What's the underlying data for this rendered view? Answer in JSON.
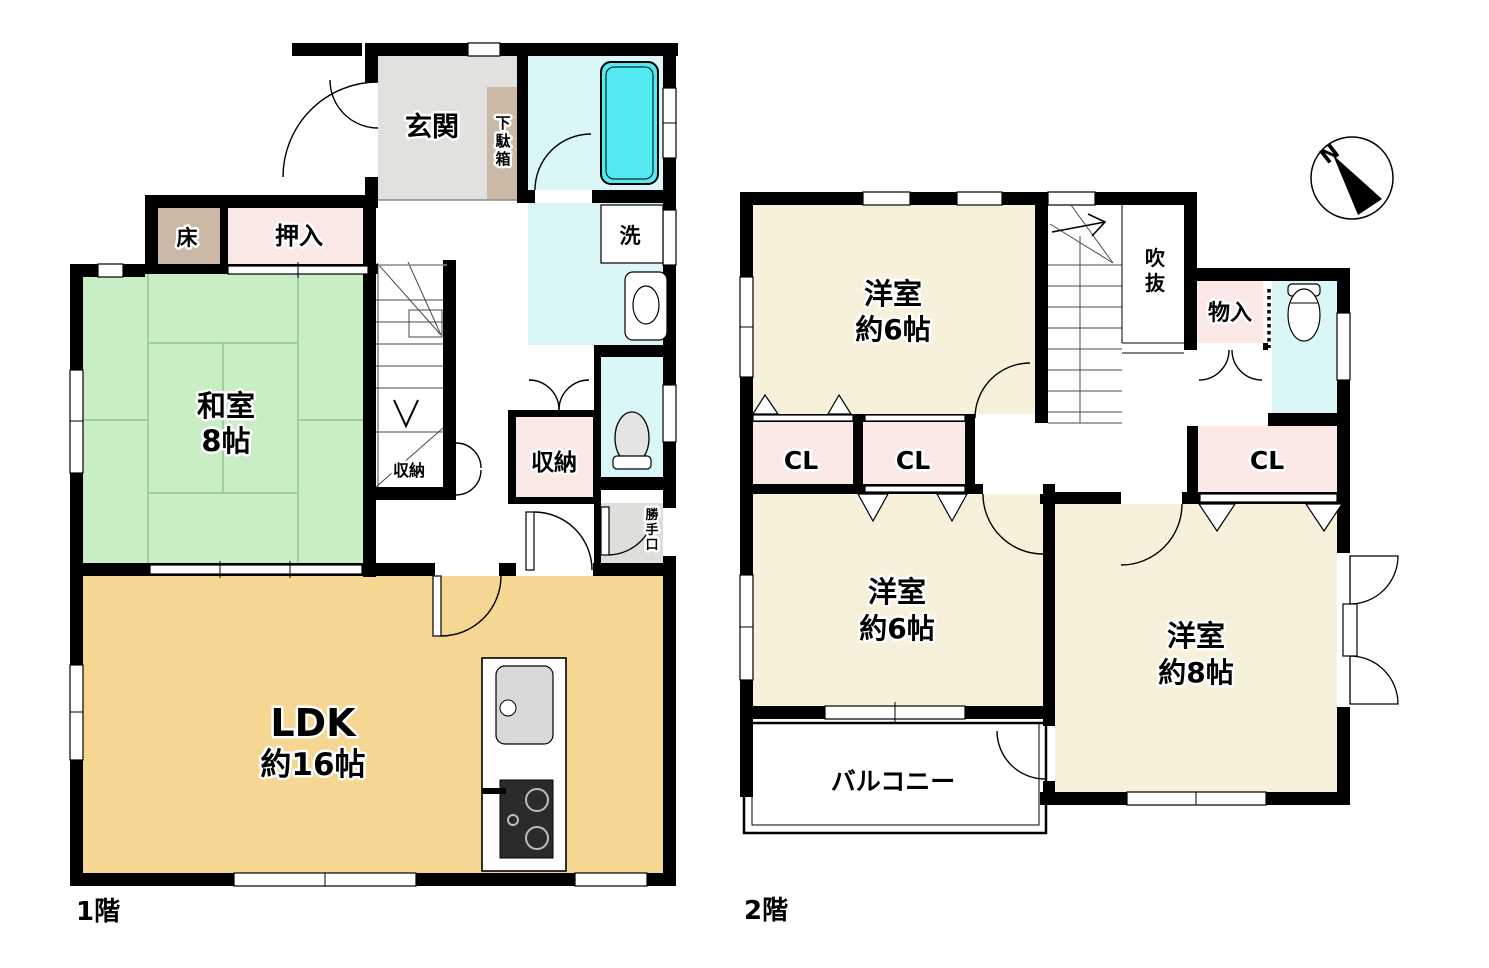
{
  "floor1": {
    "label": "1階",
    "entrance": "玄関",
    "shoe_cabinet": "下駄箱",
    "tokonoma": "床",
    "closet": "押入",
    "japanese_room": [
      "和室",
      "8帖"
    ],
    "stair_storage": "収納",
    "hall_storage": "収納",
    "laundry": "洗",
    "back_door": "勝手口",
    "ldk": [
      "LDK",
      "約16帖"
    ]
  },
  "floor2": {
    "label": "2階",
    "room_top": [
      "洋室",
      "約6帖"
    ],
    "void": "吹抜",
    "storage": "物入",
    "closet_left": "CL",
    "closet_mid": "CL",
    "closet_right": "CL",
    "room_bottom_left": [
      "洋室",
      "約6帖"
    ],
    "room_right": [
      "洋室",
      "約8帖"
    ],
    "balcony": "バルコニー"
  },
  "compass": {
    "north": "N"
  },
  "colors": {
    "wall": "#000000",
    "tatami_green": "#c9eec6",
    "ldk_wood": "#f5d793",
    "room_cream": "#f7f0da",
    "closet_pink": "#fbe9e8",
    "wood_tan": "#c9b9a6",
    "bath_floor": "#daf6f6",
    "tub_cyan": "#52e9f0",
    "entry_gray": "#e2e1de"
  }
}
